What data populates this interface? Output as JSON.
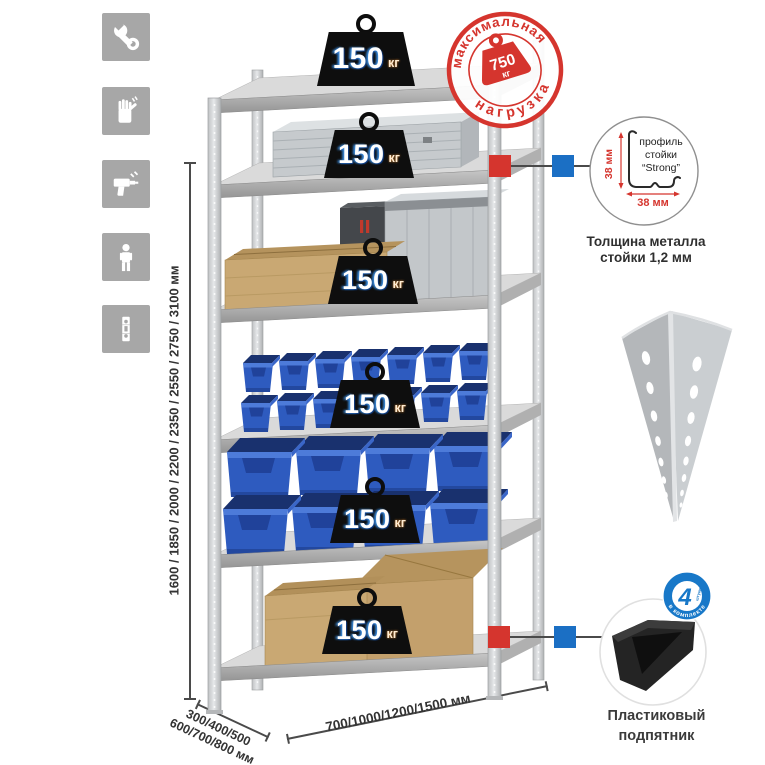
{
  "badge": {
    "value": "150",
    "unit": "кг"
  },
  "stamp": {
    "arc_top": "максимальная",
    "arc_bottom": "нагрузка",
    "weight_value": "750",
    "weight_unit": "кг"
  },
  "dimensions": {
    "height": "1600 / 1850 / 2000 / 2200 / 2350 / 2550 / 2750 / 3100 мм",
    "depth_line1": "300/400/500",
    "depth_line2": "600/700/800 мм",
    "width": "700/1000/1200/1500 мм"
  },
  "profile_callout": {
    "dim_vertical": "38 мм",
    "dim_horizontal": "38 мм",
    "label_line1": "профиль",
    "label_line2": "стойки",
    "label_line3": "“Strong”",
    "caption_line1": "Толщина металла",
    "caption_line2": "стойки 1,2 мм"
  },
  "foot_callout": {
    "badge_number": "4",
    "badge_units": "штуки",
    "badge_ring_text": "в комплекте",
    "caption_line1": "Пластиковый",
    "caption_line2": "подпятник"
  },
  "sidebar": {
    "icons": [
      "wrench-icon",
      "work-gloves-icon",
      "drill-icon",
      "person-icon",
      "perforated-post-icon"
    ]
  },
  "colors": {
    "accent_red": "#d5352e",
    "accent_blue": "#1b6fc4",
    "bin_blue": "#2e5bbf",
    "metal_gray": "#c9cbcd",
    "icon_gray": "#a7a7a7"
  }
}
